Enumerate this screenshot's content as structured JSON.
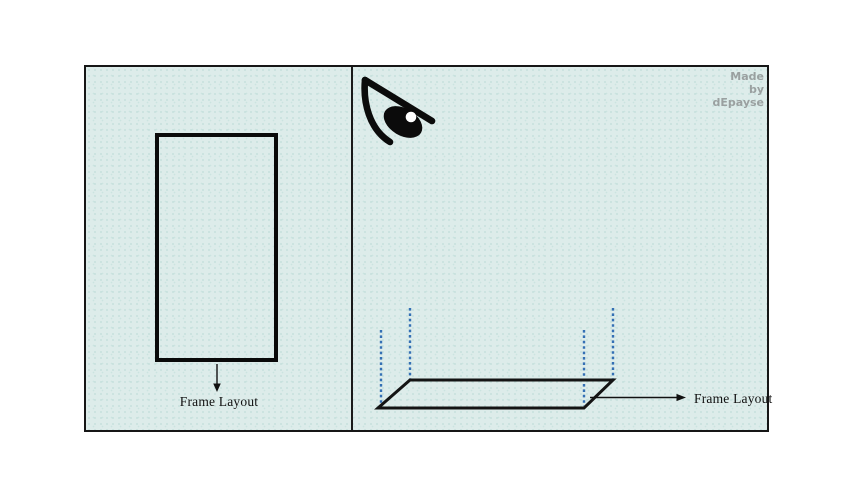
{
  "diagram": {
    "left_panel": {
      "shape": "rectangle-2d-frame",
      "label": "Frame Layout"
    },
    "right_panel": {
      "shape": "plane-3d-perspective",
      "label": "Frame Layout",
      "icon": "eye-icon",
      "watermark": {
        "lines": [
          "Made",
          "by",
          "dEpayse"
        ]
      }
    },
    "colors": {
      "page_background": "#ffffff",
      "panel_background": "#ddecea",
      "frame_border": "#161616",
      "shape_stroke": "#0a0a0a",
      "dashed_guide": "#3470b4",
      "watermark_text": "#9aa0a0",
      "label_text": "#111111"
    }
  }
}
